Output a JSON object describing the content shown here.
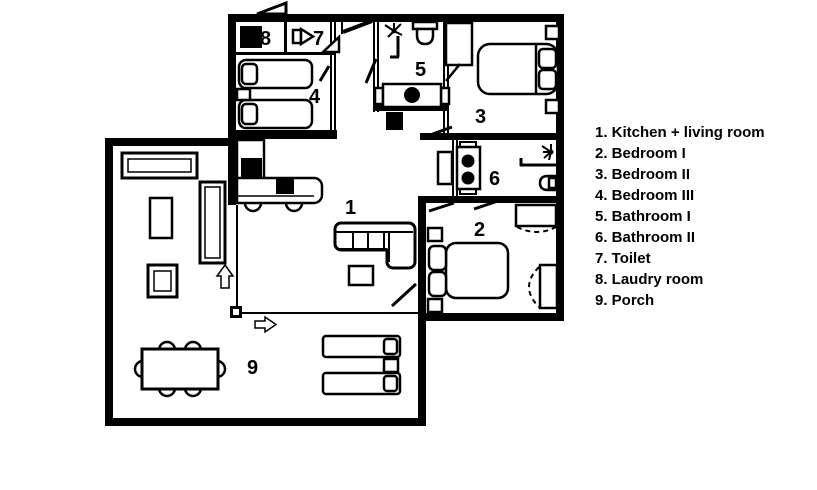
{
  "plan": {
    "room_numbers": {
      "kitchen_living": "1",
      "bedroom_1": "2",
      "bedroom_2": "3",
      "bedroom_3": "4",
      "bathroom_1": "5",
      "bathroom_2": "6",
      "toilet": "7",
      "laundry": "8",
      "porch": "9"
    }
  },
  "legend": {
    "items": [
      "1. Kitchen + living room",
      "2. Bedroom I",
      "3. Bedroom II",
      "4. Bedroom III",
      "5. Bathroom I",
      "6. Bathroom II",
      "7. Toilet",
      "8. Laudry room",
      "9. Porch"
    ]
  },
  "colors": {
    "wall": "#000000",
    "background": "#ffffff",
    "text": "#000000"
  }
}
